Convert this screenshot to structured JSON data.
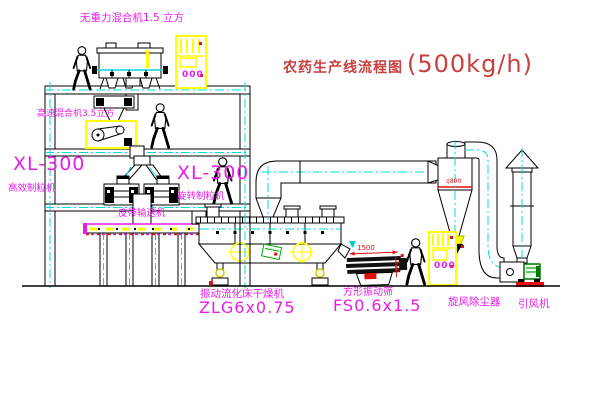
{
  "title": {
    "text_cn": "农药生产线流程图",
    "capacity": "(500kg/h)"
  },
  "labels": {
    "gravity_mixer": "无重力混合机1.5 立方",
    "high_speed_mixer": "高速混合机3.5立方",
    "granulator_left_model": "XL-300",
    "granulator_left_name": "高效制粒机",
    "granulator_right_model": "XL-300",
    "granulator_right_name": "旋转制粒机",
    "belt_conveyor": "皮带输送机",
    "fluid_bed_dryer_name": "振动流化床干燥机",
    "fluid_bed_dryer_model": "ZLG6x0.75",
    "vibrating_screen_name": "方形振动筛",
    "vibrating_screen_model": "FS0.6x1.5",
    "cyclone_name": "旋风除尘器",
    "fan_name": "引风机"
  },
  "dimensions": {
    "cyclone_diameter": "¢800",
    "screen_length": "1500",
    "screen_height": "550"
  },
  "cabinets": {
    "display_1": "000",
    "display_2": "000"
  },
  "colors": {
    "label_magenta": "#e81ee8",
    "title_red": "#c84040",
    "cad_red": "#e01010",
    "cad_yellow": "#ffff00",
    "cad_cyan": "#00dcdc",
    "motor_green": "#008800",
    "line_black": "#000000"
  }
}
